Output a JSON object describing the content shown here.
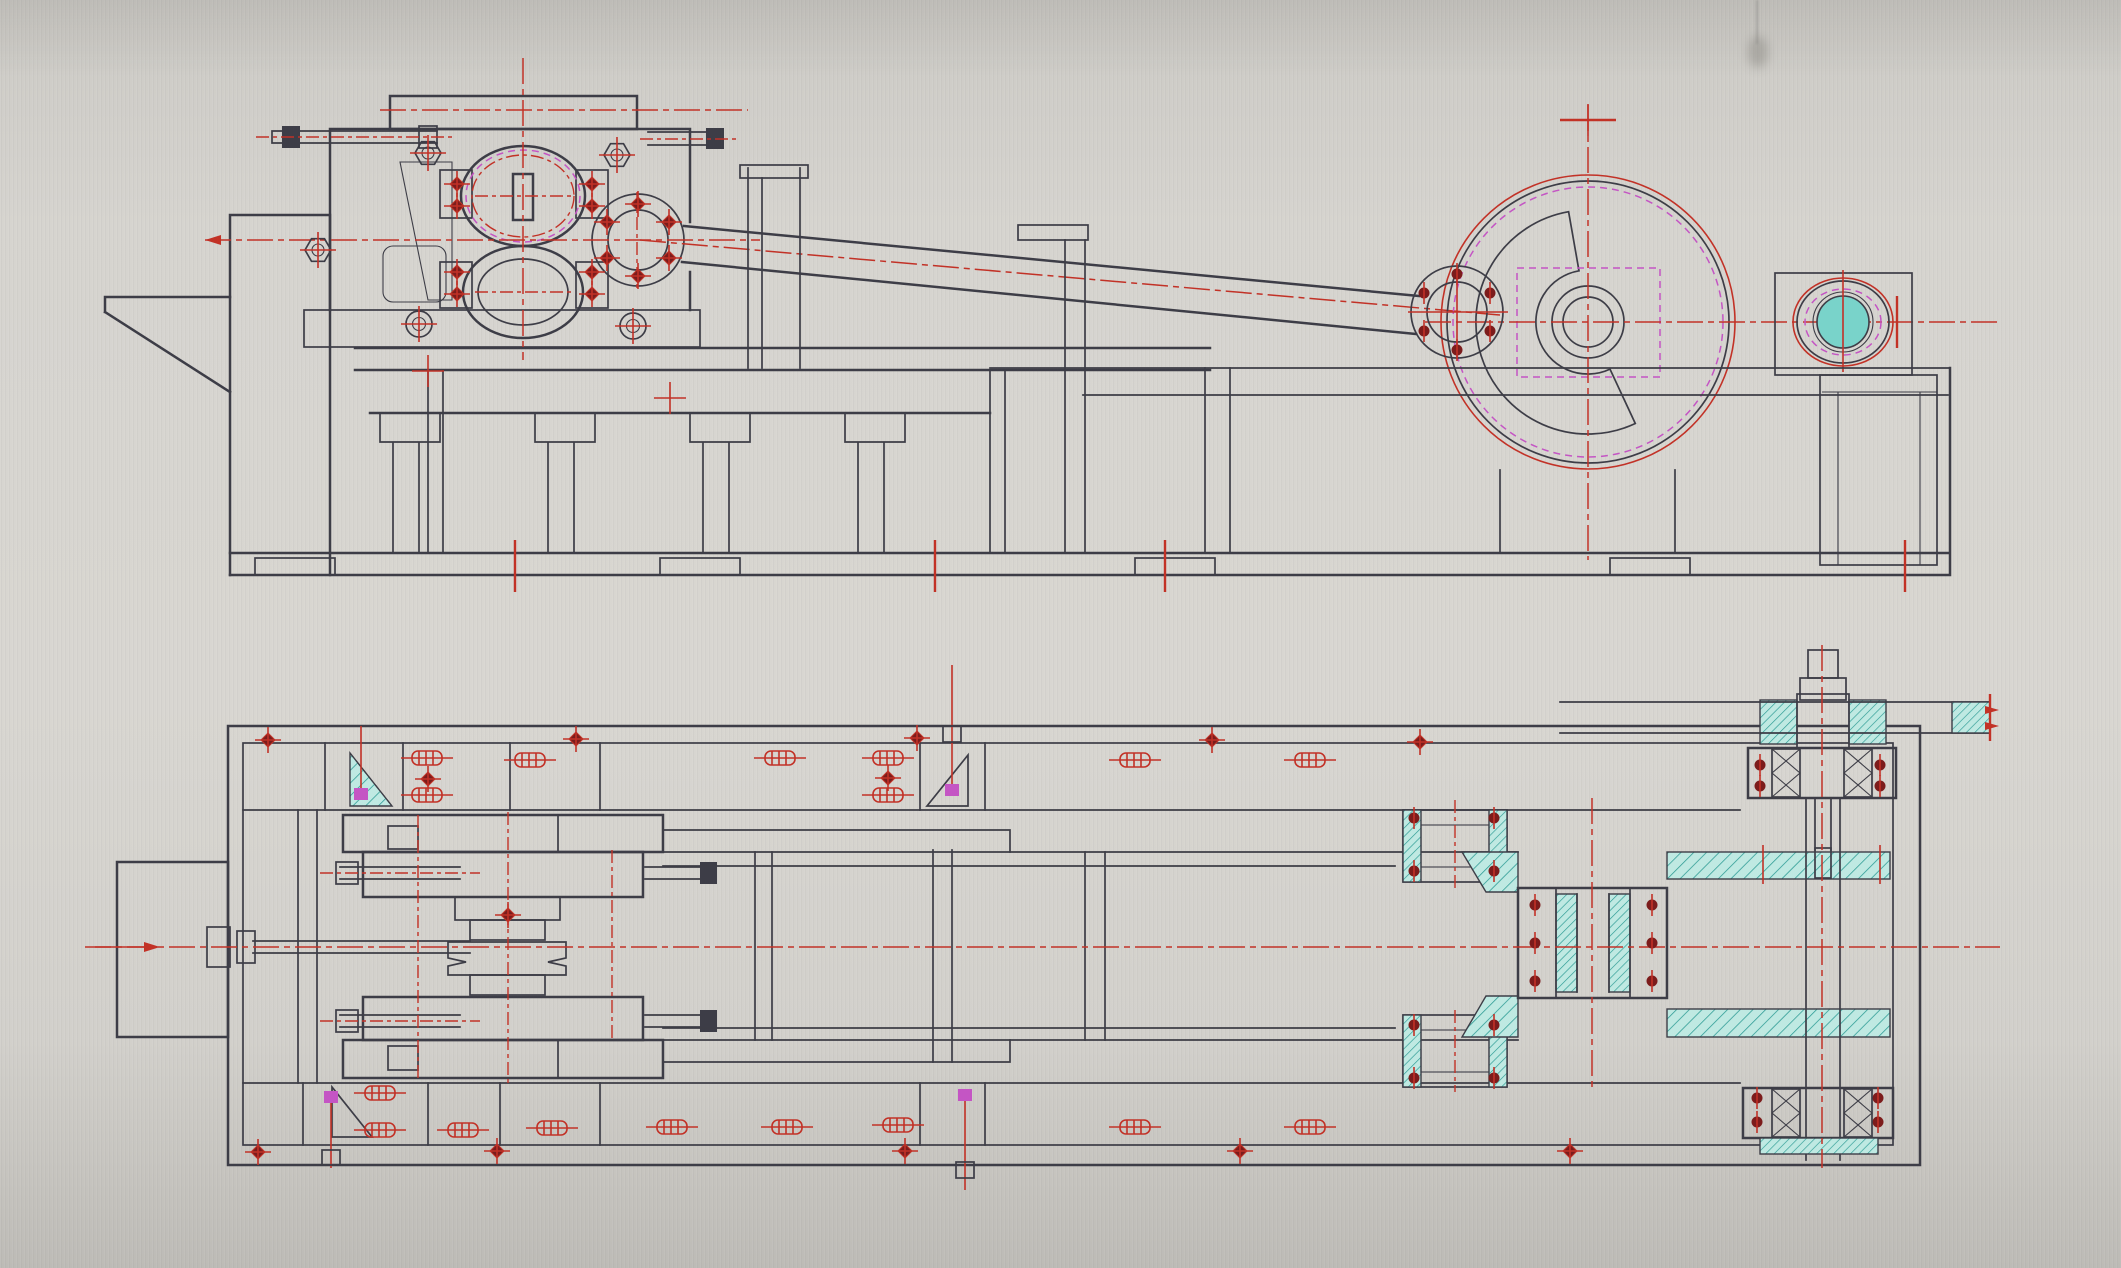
{
  "scene": {
    "subject": "CAD engineering drawing, two orthographic views of a crank press machine",
    "views": [
      "side-elevation",
      "plan"
    ]
  },
  "colors": {
    "ink": "#3d3d46",
    "red": "#c23028",
    "darkred": "#7c1f1d",
    "magenta": "#c455c4",
    "cyan": "#2a9a93",
    "cyan_fill": "#bfe9e2",
    "cyan_solid": "#79d3ca",
    "paper": "#d4d2cd",
    "paper_dark": "#bfbdb8",
    "paper_light": "#dddbd6"
  },
  "elevation": {
    "hex_bolts": [
      [
        428,
        153
      ],
      [
        617,
        155
      ],
      [
        318,
        250
      ]
    ],
    "circle_bolts": [
      [
        419,
        324
      ],
      [
        633,
        326
      ]
    ],
    "diamond_bolts": [
      [
        457,
        184
      ],
      [
        457,
        206
      ],
      [
        592,
        184
      ],
      [
        592,
        206
      ],
      [
        457,
        272
      ],
      [
        457,
        294
      ],
      [
        592,
        272
      ],
      [
        592,
        294
      ]
    ],
    "small_flange_bolts": [
      [
        638,
        204
      ],
      [
        669,
        222
      ],
      [
        669,
        258
      ],
      [
        638,
        276
      ],
      [
        607,
        258
      ],
      [
        607,
        222
      ]
    ],
    "big_flange_bolts": [
      [
        1457,
        274
      ],
      [
        1490,
        293
      ],
      [
        1490,
        331
      ],
      [
        1457,
        350
      ],
      [
        1424,
        331
      ],
      [
        1424,
        293
      ]
    ],
    "base_ticks": [
      [
        515,
        566
      ],
      [
        935,
        566
      ],
      [
        1165,
        566
      ],
      [
        1905,
        566
      ]
    ],
    "cross_marks": [
      [
        670,
        398
      ],
      [
        428,
        371
      ],
      [
        1588,
        120
      ]
    ]
  },
  "plan": {
    "studs": [
      [
        427,
        758
      ],
      [
        427,
        795
      ],
      [
        530,
        760
      ],
      [
        780,
        758
      ],
      [
        888,
        758
      ],
      [
        888,
        795
      ],
      [
        1135,
        760
      ],
      [
        1310,
        760
      ],
      [
        380,
        1093
      ],
      [
        380,
        1130
      ],
      [
        463,
        1130
      ],
      [
        552,
        1128
      ],
      [
        672,
        1127
      ],
      [
        787,
        1127
      ],
      [
        898,
        1125
      ],
      [
        1135,
        1127
      ],
      [
        1310,
        1127
      ]
    ],
    "edge_diamonds": [
      [
        268,
        740
      ],
      [
        576,
        739
      ],
      [
        917,
        738
      ],
      [
        1212,
        740
      ],
      [
        1420,
        742
      ],
      [
        258,
        1152
      ],
      [
        497,
        1151
      ],
      [
        905,
        1151
      ],
      [
        1240,
        1151
      ],
      [
        1570,
        1151
      ]
    ],
    "dark_dots": [
      [
        1535,
        905
      ],
      [
        1535,
        943
      ],
      [
        1535,
        981
      ],
      [
        1652,
        905
      ],
      [
        1652,
        943
      ],
      [
        1652,
        981
      ],
      [
        1414,
        818
      ],
      [
        1494,
        818
      ],
      [
        1414,
        871
      ],
      [
        1494,
        871
      ],
      [
        1414,
        1025
      ],
      [
        1494,
        1025
      ],
      [
        1414,
        1078
      ],
      [
        1494,
        1078
      ],
      [
        1760,
        765
      ],
      [
        1760,
        786
      ],
      [
        1880,
        765
      ],
      [
        1880,
        786
      ],
      [
        1757,
        1098
      ],
      [
        1757,
        1122
      ],
      [
        1878,
        1098
      ],
      [
        1878,
        1122
      ]
    ],
    "small_diamonds": [
      [
        508,
        915
      ],
      [
        428,
        779
      ],
      [
        888,
        778
      ]
    ],
    "magenta_squares": [
      [
        361,
        794
      ],
      [
        952,
        790
      ],
      [
        331,
        1097
      ],
      [
        965,
        1095
      ]
    ],
    "x_bearings": [
      [
        1786,
        773
      ],
      [
        1858,
        773
      ],
      [
        1786,
        1113
      ],
      [
        1858,
        1113
      ]
    ]
  }
}
